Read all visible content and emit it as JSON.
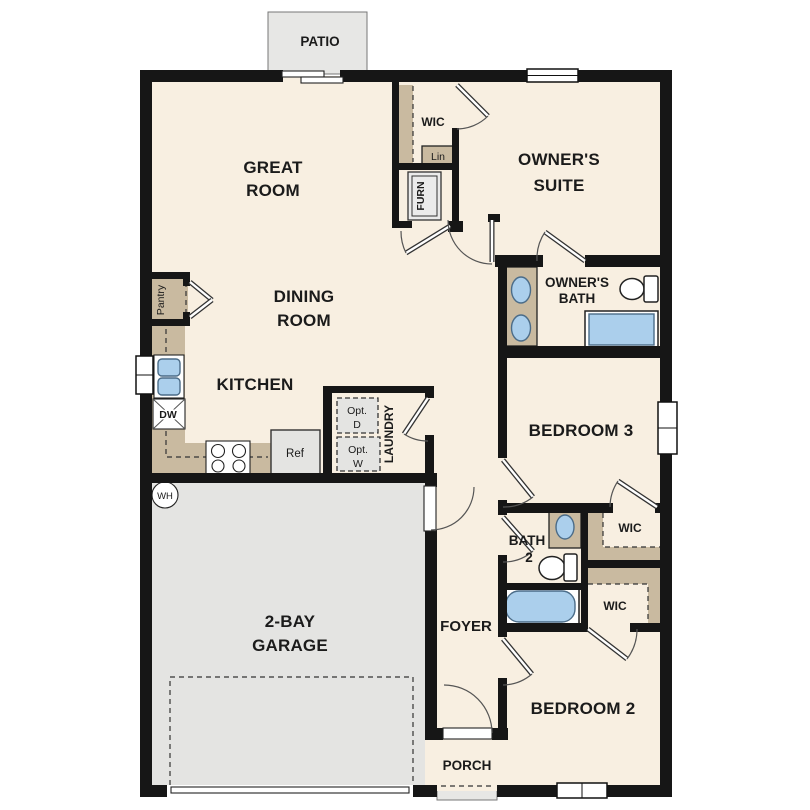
{
  "colors": {
    "wall": "#161616",
    "floor": "#f8efe1",
    "garage": "#e4e4e2",
    "slab": "#e7e7e5",
    "counter": "#c9baa0",
    "fixture_blue": "#abcfec",
    "appliance": "#e4e4e2"
  },
  "labels": {
    "patio": "PATIO",
    "great_room": [
      "GREAT",
      "ROOM"
    ],
    "wic_owner": "WIC",
    "linen": "Lin",
    "furnace": "FURN",
    "owners_suite": [
      "OWNER'S",
      "SUITE"
    ],
    "owners_bath": [
      "OWNER'S",
      "BATH"
    ],
    "pantry": "Pantry",
    "dining_room": [
      "DINING",
      "ROOM"
    ],
    "kitchen": "KITCHEN",
    "dishwasher": "DW",
    "refrigerator": "Ref",
    "opt_dryer": [
      "Opt.",
      "D"
    ],
    "opt_washer": [
      "Opt.",
      "W"
    ],
    "laundry": "LAUNDRY",
    "bedroom3": "BEDROOM 3",
    "water_heater": "WH",
    "garage": [
      "2-BAY",
      "GARAGE"
    ],
    "foyer": "FOYER",
    "bath2": [
      "BATH",
      "2"
    ],
    "wic_bedroom3": "WIC",
    "wic_bedroom2": "WIC",
    "bedroom2": "BEDROOM 2",
    "porch": "PORCH"
  }
}
